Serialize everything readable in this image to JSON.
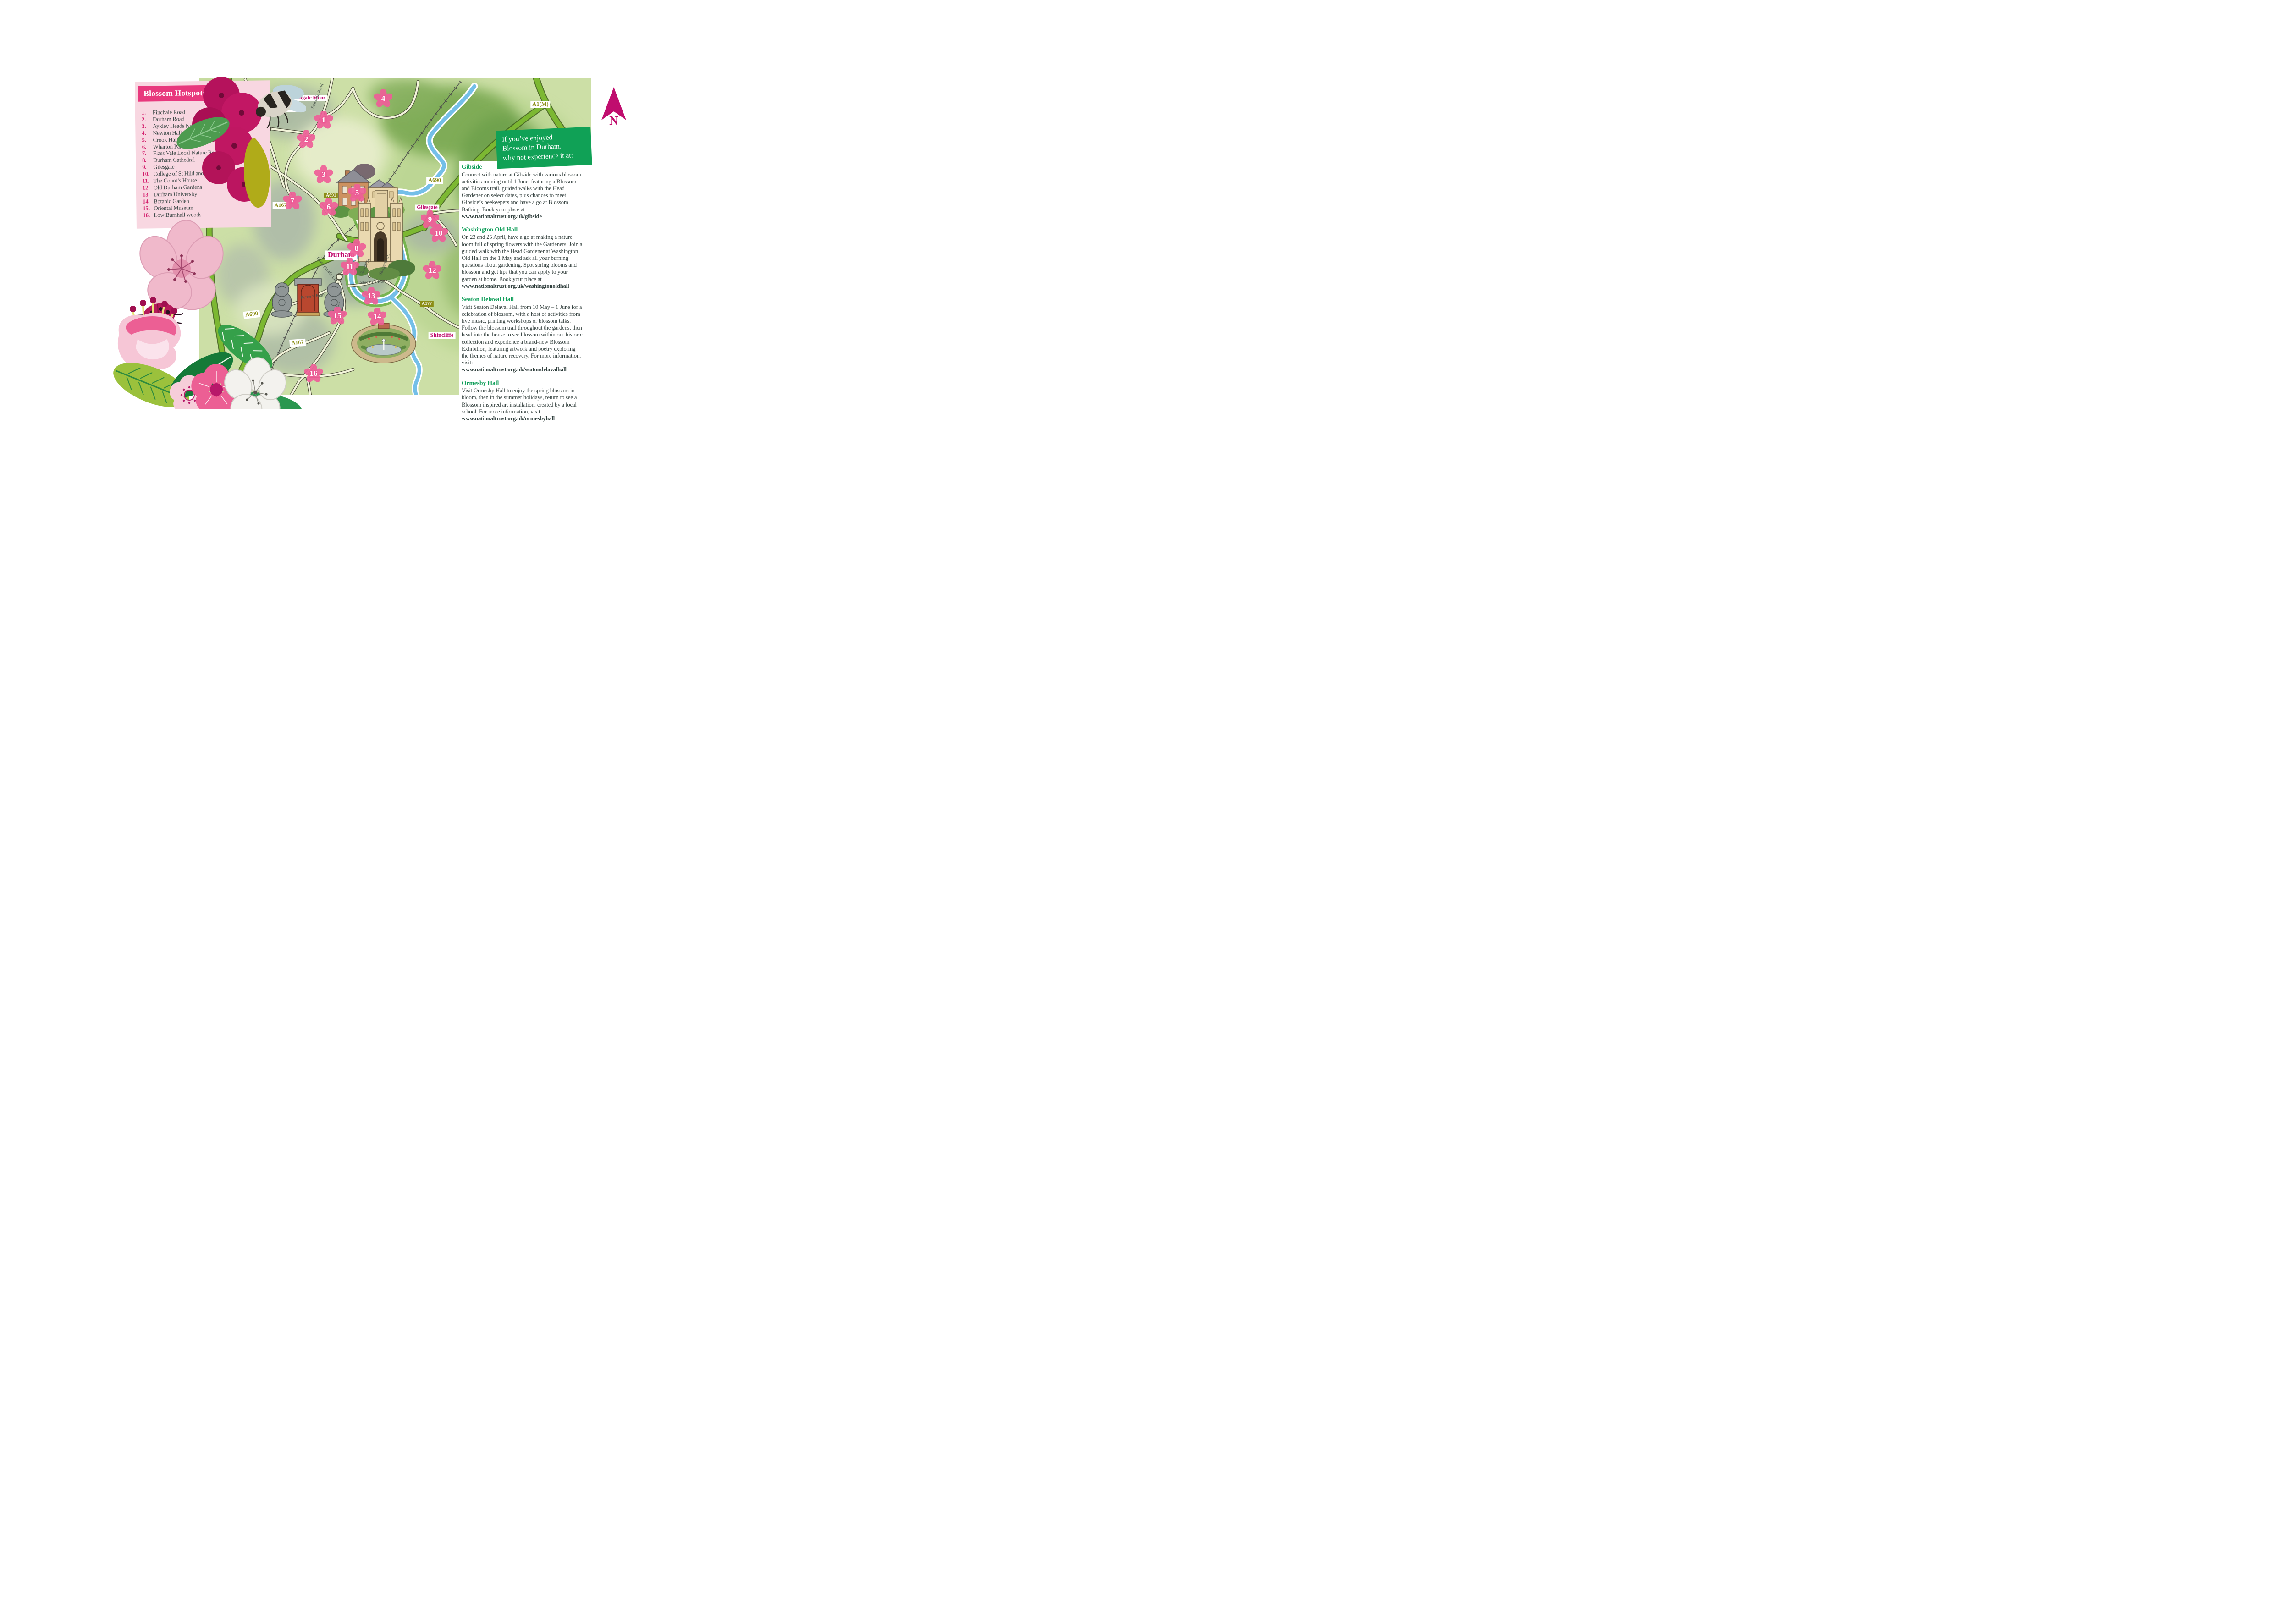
{
  "hotspots_panel": {
    "title": "Blossom Hotspots",
    "items": [
      {
        "num": "1.",
        "label": "Finchale Road"
      },
      {
        "num": "2.",
        "label": "Durham Road"
      },
      {
        "num": "3.",
        "label": "Aykley Heads Nature Reserve"
      },
      {
        "num": "4.",
        "label": "Newton Hall"
      },
      {
        "num": "5.",
        "label": "Crook Hall Gardens"
      },
      {
        "num": "6.",
        "label": "Wharton Park"
      },
      {
        "num": "7.",
        "label": "Flass Vale Local Nature Reserve"
      },
      {
        "num": "8.",
        "label": "Durham Cathedral"
      },
      {
        "num": "9.",
        "label": "Gilesgate"
      },
      {
        "num": "10.",
        "label": "College of St Hild and St Bede (Pelaw Wood)"
      },
      {
        "num": "11.",
        "label": "The Count’s House"
      },
      {
        "num": "12.",
        "label": "Old Durham Gardens"
      },
      {
        "num": "13.",
        "label": "Durham University"
      },
      {
        "num": "14.",
        "label": "Botanic Garden"
      },
      {
        "num": "15.",
        "label": "Oriental Museum"
      },
      {
        "num": "16.",
        "label": "Low Burnhall woods"
      }
    ]
  },
  "promo": {
    "heading_lines": [
      "If you’ve enjoyed",
      "Blossom in Durham,",
      "why not experience it at:"
    ],
    "sections": [
      {
        "title": "Gibside",
        "body": "Connect with nature at Gibside with various blossom activities running until 1 June, featuring a Blossom and Blooms trail, guided walks with the Head Gardener on select dates, plus chances to meet Gibside’s beekeepers and have a go at Blossom Bathing. Book your place at",
        "link": "www.nationaltrust.org.uk/gibside"
      },
      {
        "title": "Washington Old Hall",
        "body": "On 23 and 25 April, have a go at making a nature loom full of spring flowers with the Gardeners. Join a guided walk with the Head Gardener at Washington Old Hall on the 1 May and ask all your burning questions about gardening. Spot spring blooms and blossom and get tips that you can apply to your garden at home. Book your place at",
        "link": "www.nationaltrust.org.uk/washingtonoldhall"
      },
      {
        "title": "Seaton Delaval Hall",
        "body": "Visit Seaton Delaval Hall from 10 May – 1 June for a celebration of blossom, with a host of activities from live music, printing workshops or blossom talks. Follow the blossom trail throughout the gardens, then head into the house to see blossom within our historic collection and experience a brand-new Blossom Exhibition, featuring artwork and poetry exploring the themes of nature recovery. For more information, visit:",
        "link": "www.nationaltrust.org.uk/seatondelavalhall"
      },
      {
        "title": "Ormesby Hall",
        "body": "Visit Ormesby Hall to enjoy the spring blossom in bloom, then in the summer holidays, return to see a Blossom inspired art installation, created by a local school. For more information, visit",
        "link": "www.nationaltrust.org.uk/ormesbyhall"
      }
    ]
  },
  "map": {
    "markers": [
      "1",
      "2",
      "3",
      "4",
      "5",
      "6",
      "7",
      "8",
      "9",
      "10",
      "11",
      "12",
      "13",
      "14",
      "15",
      "16"
    ],
    "place_labels": {
      "framwellgate": "Framwellgate Moor",
      "durham": "Durham",
      "gilesgate": "Gilesgate",
      "langley_line1": "Langley",
      "langley_line2": "Moor",
      "shincliffe": "Shincliffe"
    },
    "road_badges": {
      "a167": "A167",
      "a690": "A690",
      "a691": "A691",
      "a177": "A177",
      "a1m": "A1(M)"
    },
    "road_names": {
      "finchale": "Finchale Road",
      "stockton": "Stockton Rd.",
      "south": "South Road",
      "potters": "Potter’s Bank",
      "quarryheads": "Quarryheads Ln.",
      "church": "Church St.",
      "hallgarth": "Hallgarth St."
    },
    "compass_letter": "N"
  },
  "colors": {
    "brand_pink": "#e8387d",
    "panel_pink": "#f8d7e1",
    "magenta_label": "#c00d6e",
    "brand_green": "#10a156",
    "olive": "#8b8d15",
    "river_blue": "#74bfe8",
    "road_green": "#7cb832"
  }
}
